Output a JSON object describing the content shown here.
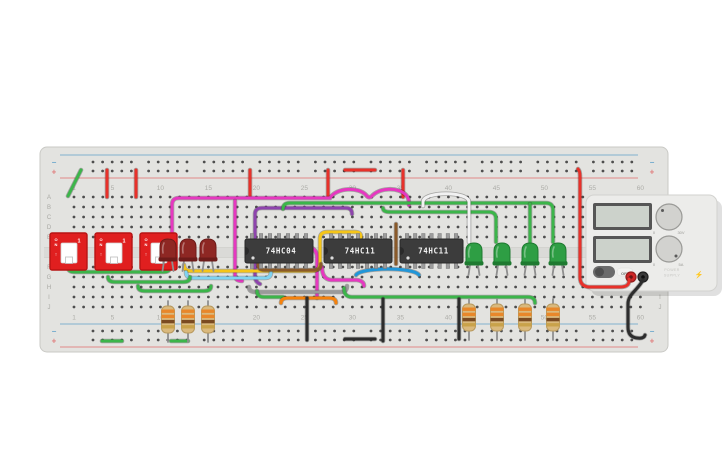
{
  "board": {
    "row_labels": [
      "A",
      "B",
      "C",
      "D",
      "E",
      "F",
      "G",
      "H",
      "I",
      "J"
    ],
    "column_numbers": [
      "1",
      "5",
      "10",
      "15",
      "20",
      "25",
      "30",
      "35",
      "40",
      "45",
      "50",
      "55",
      "60"
    ],
    "minus_symbol": "−",
    "plus_symbol": "+",
    "board_color": "#e3e3e0",
    "channel_color": "#dadad7",
    "hole_color": "#4e4e4e",
    "rail_blue": "#6fa8cc",
    "rail_red": "#e07a7a",
    "label_color": "#a9a9a4"
  },
  "switches": [
    {
      "on_label": "ON",
      "arrow": "↑",
      "pos_label": "1"
    },
    {
      "on_label": "ON",
      "arrow": "↑",
      "pos_label": "1"
    },
    {
      "on_label": "ON",
      "arrow": "↑",
      "pos_label": "1"
    }
  ],
  "ics": [
    {
      "label": "74HC04"
    },
    {
      "label": "74HC11"
    },
    {
      "label": "74HC11"
    }
  ],
  "leds": {
    "red_body": "#8e2723",
    "red_rim": "#6d1b19",
    "green_body": "#2e9e44",
    "green_rim": "#1e7a30",
    "lead_color": "#8f8f8f"
  },
  "resistors": {
    "body_color": "#dab97d",
    "edge_color": "#b89a5f",
    "band_colors": [
      "#e8872a",
      "#e8872a",
      "#7a4a21",
      "#c9a24a"
    ],
    "lead_color": "#8f8f8f"
  },
  "power_supply": {
    "body_color": "#ececea",
    "screen_color": "#ccd2cb",
    "screen_frame": "#565656",
    "off_label": "OFF",
    "voltage_knob": {
      "min_label": "0",
      "max_label": "30V"
    },
    "current_knob": {
      "min_label": "0",
      "max_label": "5A"
    },
    "brand_line1": "POWER",
    "brand_line2": "SUPPLY",
    "bolt": "⚡",
    "terminal_red": "#cf2525",
    "terminal_black": "#353535"
  },
  "wires": [
    {
      "name": "green-rail-jumper-topleft",
      "hex": "#3cb54a",
      "d": "M81,170 L68,196"
    },
    {
      "name": "red-rail-jumper-1",
      "hex": "#e8312a",
      "d": "M107,170 V197"
    },
    {
      "name": "red-rail-jumper-2",
      "hex": "#e8312a",
      "d": "M136,170 V197"
    },
    {
      "name": "red-rail-jumper-3",
      "hex": "#e8312a",
      "d": "M250,170 V197"
    },
    {
      "name": "red-rail-jumper-4",
      "hex": "#e8312a",
      "d": "M328,170 V197"
    },
    {
      "name": "red-rail-jumper-5",
      "hex": "#e8312a",
      "d": "M403,170 V197"
    },
    {
      "name": "red-rail-bridge",
      "hex": "#e8312a",
      "d": "M345,170 H375"
    },
    {
      "name": "pink-long-hop",
      "hex": "#e638c0",
      "d": "M172,265 V205 Q172,198 179,198 H330 C337,187 359,187 366,195 Q368,198 371,197 C379,187 399,187 406,195 Q409,198 409,203 V205"
    },
    {
      "name": "pink-vertical",
      "hex": "#e638c0",
      "d": "M235,201 V275 Q235,281 242,281"
    },
    {
      "name": "pink-ic2-down",
      "hex": "#e638c0",
      "d": "M308,246 Q317,249 317,257 V298"
    },
    {
      "name": "pink-ic2-curve",
      "hex": "#e638c0",
      "d": "M322,267 Q322,279 331,280 H357 Q364,281 364,286"
    },
    {
      "name": "purple-wire",
      "hex": "#8e44ad",
      "d": "M260,284 Q255,282 255,276 V214 Q255,208 262,208 H346 Q352,208 352,214"
    },
    {
      "name": "yellow-wire",
      "hex": "#f5c518",
      "d": "M184,265 Q184,271 191,271 H312 Q320,271 320,263 V239 Q320,232 327,232 H355 Q361,232 361,237"
    },
    {
      "name": "cyan-wire",
      "hex": "#7fd4f2",
      "d": "M186,272 Q186,278 193,278 H265 Q271,278 271,272"
    },
    {
      "name": "brown-long",
      "hex": "#8a5a2a",
      "d": "M258,264 Q258,270 265,270 H315 Q321,270 321,264"
    },
    {
      "name": "brown-short",
      "hex": "#8a5a2a",
      "d": "M396,224 V264"
    },
    {
      "name": "blue-arc",
      "hex": "#2196d8",
      "d": "M356,275 C361,267 414,267 419,275"
    },
    {
      "name": "gray-wire",
      "hex": "#9a9a9a",
      "d": "M249,287 Q249,292 256,292 H341 Q347,292 347,286"
    },
    {
      "name": "green-frow-1",
      "hex": "#3cb54a",
      "d": "M68,267 Q68,272 75,272 H163 Q170,272 170,267"
    },
    {
      "name": "green-frow-2",
      "hex": "#3cb54a",
      "d": "M108,277 Q108,282 115,282 H183 Q190,282 190,277"
    },
    {
      "name": "green-frow-3",
      "hex": "#3cb54a",
      "d": "M138,286 Q138,291 145,291 H204 Q211,291 211,286"
    },
    {
      "name": "green-mid-short",
      "hex": "#3cb54a",
      "d": "M257,291 Q257,297 264,297 H283"
    },
    {
      "name": "orange-wire",
      "hex": "#f5820d",
      "d": "M281,303 Q281,298 288,298 H329 Q336,298 336,303"
    },
    {
      "name": "green-bottom-bus",
      "hex": "#3cb54a",
      "d": "M344,288 Q344,297 352,297 H528 Q535,297 535,303"
    },
    {
      "name": "green-rowb-long",
      "hex": "#3cb54a",
      "d": "M283,209 Q283,203 290,203 H546 Q553,203 553,210 V242"
    },
    {
      "name": "green-rowc",
      "hex": "#3cb54a",
      "d": "M383,208 Q383,212 390,212 H489 Q496,212 496,219 V242"
    },
    {
      "name": "green-led3-feed",
      "hex": "#3cb54a",
      "d": "M530,204 V242"
    },
    {
      "name": "white-arc",
      "hex": "#f2f2f2",
      "d": "M423,206 V202 C423,191 469,191 469,202 V242"
    },
    {
      "name": "black-vert-1",
      "hex": "#2d2d2d",
      "d": "M307,298 V340"
    },
    {
      "name": "black-vert-2",
      "hex": "#2d2d2d",
      "d": "M383,299 V341"
    },
    {
      "name": "black-vert-3",
      "hex": "#2d2d2d",
      "d": "M459,299 V339"
    },
    {
      "name": "black-rail-seg",
      "hex": "#2d2d2d",
      "d": "M345,339 H375"
    },
    {
      "name": "green-rail-jumper-b1",
      "hex": "#3cb54a",
      "d": "M102,341 H122"
    },
    {
      "name": "green-rail-jumper-b2",
      "hex": "#3cb54a",
      "d": "M171,341 H188"
    },
    {
      "name": "red-supply-wire",
      "hex": "#e8312a",
      "d": "M578,169 Q580,171 580,176 V277 Q580,287 590,287 H620 Q628,287 629,282 V279"
    },
    {
      "name": "black-supply-wire",
      "hex": "#2d2d2d",
      "d": "M643,280 C637,291 628,294 628,304 V327 Q628,337 637,338 Q644,339 645,335"
    }
  ]
}
